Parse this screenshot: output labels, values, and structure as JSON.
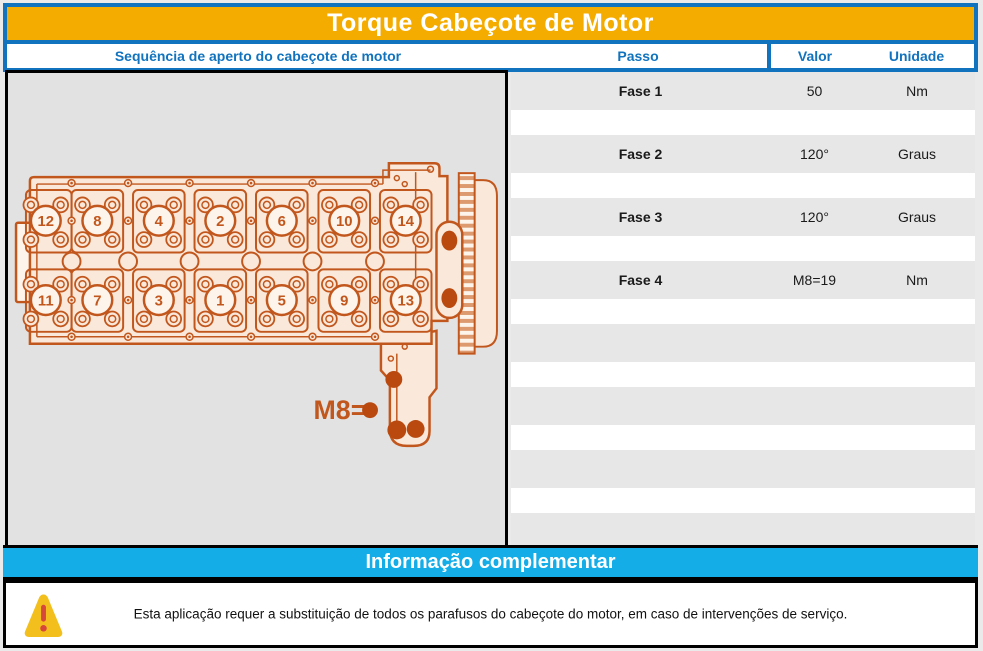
{
  "title": "Torque Cabeçote de Motor",
  "table": {
    "headers": {
      "sequence": "Sequência de aperto do cabeçote de motor",
      "step": "Passo",
      "value": "Valor",
      "unit": "Unidade"
    },
    "rows": [
      {
        "step": "Fase 1",
        "value": "50",
        "unit": "Nm"
      },
      {
        "step": "Fase 2",
        "value": "120°",
        "unit": "Graus"
      },
      {
        "step": "Fase 3",
        "value": "120°",
        "unit": "Graus"
      },
      {
        "step": "Fase 4",
        "value": "M8=19",
        "unit": "Nm"
      },
      {
        "step": "",
        "value": "",
        "unit": ""
      },
      {
        "step": "",
        "value": "",
        "unit": ""
      },
      {
        "step": "",
        "value": "",
        "unit": ""
      },
      {
        "step": "",
        "value": "",
        "unit": ""
      }
    ]
  },
  "diagram": {
    "bolt_numbers_top_row": [
      "12",
      "8",
      "4",
      "2",
      "6",
      "10",
      "14"
    ],
    "bolt_numbers_bottom_row": [
      "11",
      "7",
      "3",
      "1",
      "5",
      "9",
      "13"
    ],
    "m8_label": "M8=",
    "colors": {
      "line": "#c2571d",
      "fill": "#fae8da",
      "fill_light": "#fdf4ec",
      "dark": "#b9490f",
      "stripe": "#dd9a6e",
      "panel_bg": "#e2e2e2"
    }
  },
  "footer": {
    "info_header": "Informação complementar",
    "warning_text": "Esta aplicação requer a substituição de todos os parafusos do cabeçote do motor, em caso de intervenções de serviço."
  },
  "colors": {
    "accent_blue": "#1173be",
    "title_gold": "#f5ac00",
    "cyan": "#14ade8",
    "row_gray": "#e7e7e7",
    "warning_yellow": "#f3bf1c",
    "warning_red": "#d6483b"
  }
}
